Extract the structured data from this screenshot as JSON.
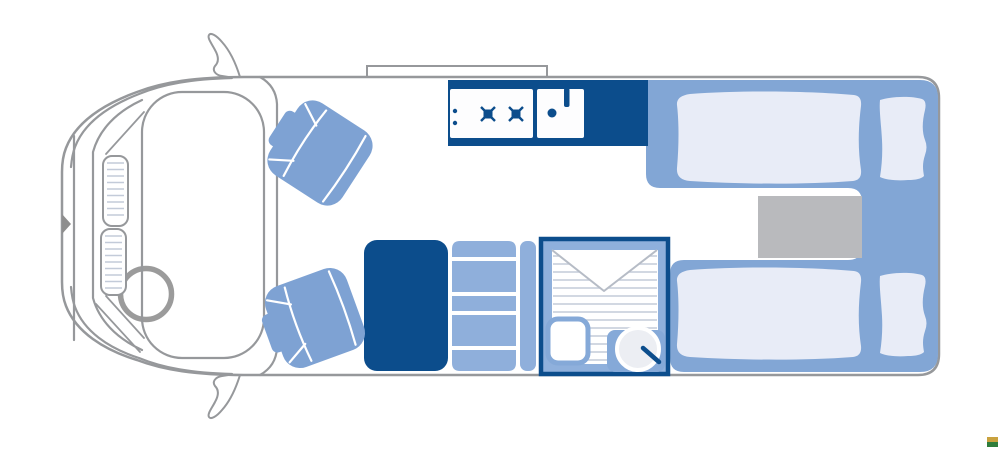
{
  "diagram": {
    "type": "motorhome-floorplan-top-view",
    "areas": {
      "cab": {
        "items": [
          "front-bumper",
          "hood",
          "windshield",
          "dashboard-vents",
          "steering-wheel",
          "side-mirror-left",
          "side-mirror-right",
          "door-marker"
        ]
      },
      "roof": {
        "items": [
          "roof-vent"
        ]
      },
      "lounge": {
        "items": [
          "swivel-seat-front",
          "swivel-seat-rear"
        ]
      },
      "kitchen": {
        "items": [
          "counter",
          "two-burner-hob",
          "hob-control-knobs",
          "sink",
          "sink-drain",
          "faucet"
        ]
      },
      "storage": {
        "items": [
          "wardrobe",
          "shelving-unit",
          "side-panel"
        ]
      },
      "bathroom": {
        "items": [
          "shower-floor",
          "folding-door-flap",
          "toilet",
          "washbasin",
          "basin-tap"
        ]
      },
      "bedroom": {
        "items": [
          "single-bed-top",
          "single-bed-bottom",
          "duvet-top",
          "duvet-bottom",
          "pillow-top",
          "pillow-bottom",
          "step-between-beds"
        ]
      }
    }
  },
  "colors": {
    "outline": "#96989B",
    "dark": "#0C4D8C",
    "platform": "#82A6D5",
    "seat": "#7EA2D3",
    "shelf": "#8FAFDB",
    "bathmargin": "#8FB0DC",
    "duvet": "#E8ECF7",
    "gray": "#B9BABD",
    "hatch": "#C3CBD9",
    "flap": "#B6BCC6",
    "fixture": "#85A9D8"
  },
  "watermark": {
    "top": "#C9A23F",
    "bottom": "#2F7D3B"
  }
}
